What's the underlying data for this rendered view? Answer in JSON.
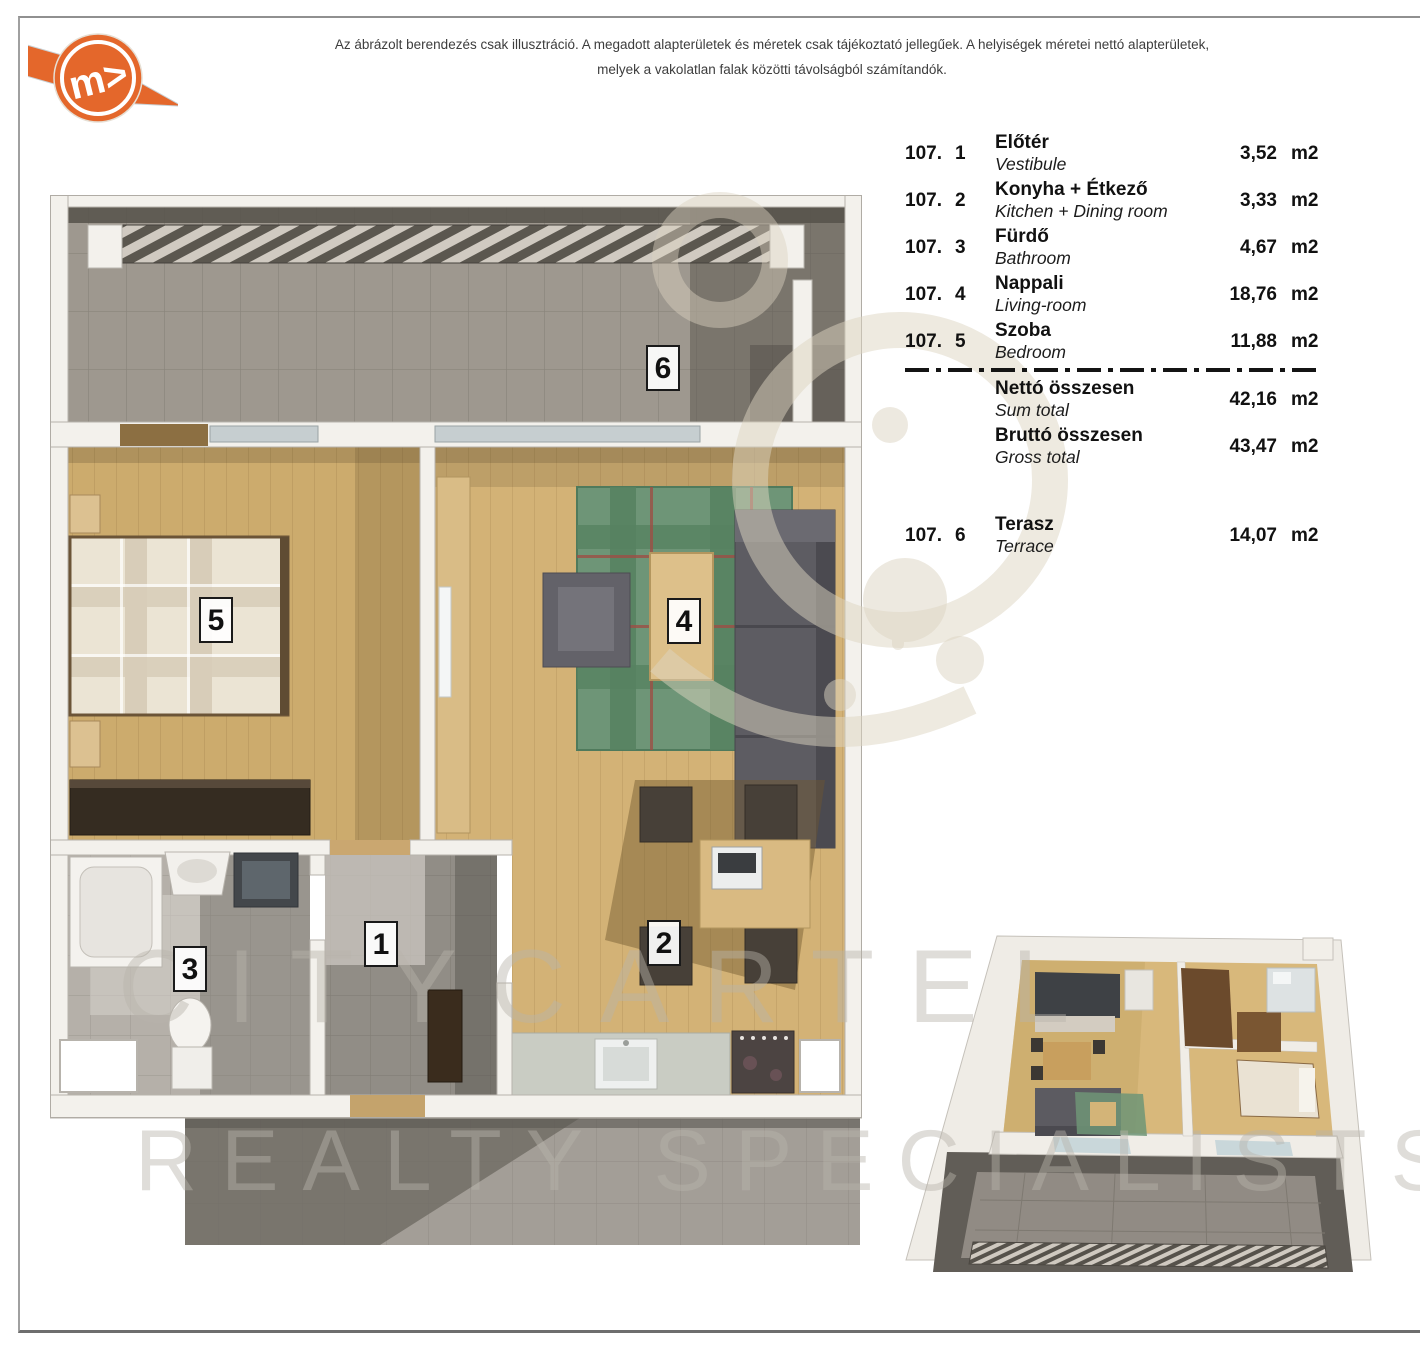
{
  "header": {
    "disclaimer_line1": "Az ábrázolt berendezés csak illusztráció. A megadott alapterületek és méretek csak tájékoztató jellegűek. A helyiségek méretei nettó alapterületek,",
    "disclaimer_line2": "melyek a vakolatlan falak közötti távolságból számítandók.",
    "logo_glyph": "m>"
  },
  "legend": {
    "rooms": [
      {
        "code": "107.",
        "unit": "1",
        "name_hu": "Előtér",
        "name_en": "Vestibule",
        "area": "3,52",
        "unit_label": "m2"
      },
      {
        "code": "107.",
        "unit": "2",
        "name_hu": "Konyha + Étkező",
        "name_en": "Kitchen + Dining room",
        "area": "3,33",
        "unit_label": "m2"
      },
      {
        "code": "107.",
        "unit": "3",
        "name_hu": "Fürdő",
        "name_en": "Bathroom",
        "area": "4,67",
        "unit_label": "m2"
      },
      {
        "code": "107.",
        "unit": "4",
        "name_hu": "Nappali",
        "name_en": "Living-room",
        "area": "18,76",
        "unit_label": "m2"
      },
      {
        "code": "107.",
        "unit": "5",
        "name_hu": "Szoba",
        "name_en": "Bedroom",
        "area": "11,88",
        "unit_label": "m2"
      }
    ],
    "totals": [
      {
        "name_hu": "Nettó összesen",
        "name_en": "Sum total",
        "area": "42,16",
        "unit_label": "m2"
      },
      {
        "name_hu": "Bruttó összesen",
        "name_en": "Gross total",
        "area": "43,47",
        "unit_label": "m2"
      }
    ],
    "terrace": {
      "code": "107.",
      "unit": "6",
      "name_hu": "Terasz",
      "name_en": "Terrace",
      "area": "14,07",
      "unit_label": "m2"
    }
  },
  "plan": {
    "labels": {
      "l1": "1",
      "l2": "2",
      "l3": "3",
      "l4": "4",
      "l5": "5",
      "l6": "6"
    }
  },
  "watermark": {
    "line1": "CITYCARTEL",
    "line2": "REALTY SPECIALISTS"
  },
  "colors": {
    "brand_orange": "#e4672b",
    "wall": "#f3f1ec",
    "wood_floor": "#d3b276",
    "terrace_tile": "#9e988f",
    "rug_green": "#6e9577"
  }
}
